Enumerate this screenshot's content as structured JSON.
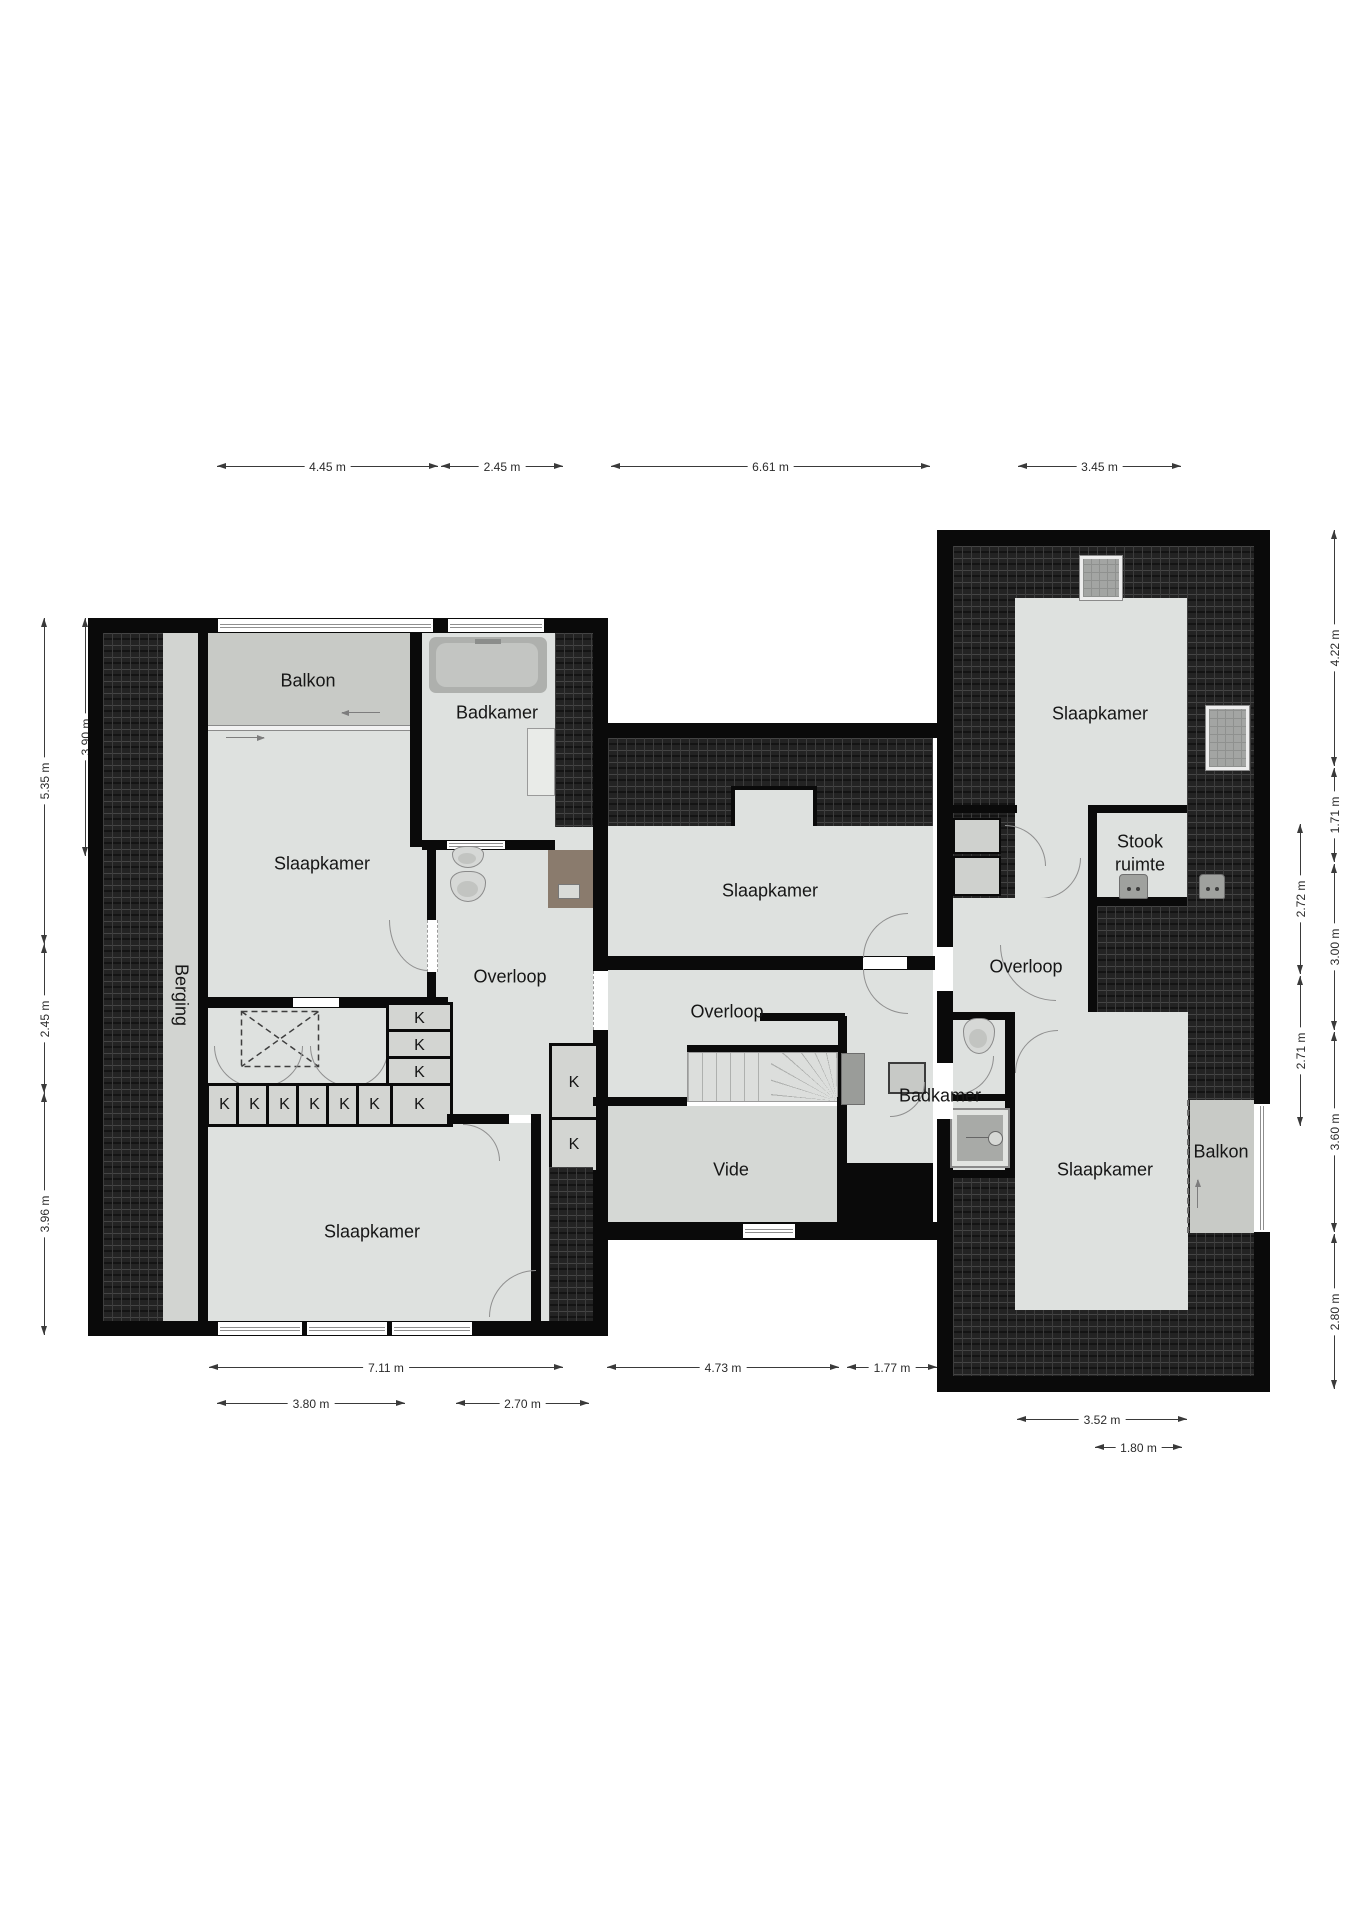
{
  "labels": {
    "closet": "K",
    "rooms": {
      "balkon_left": "Balkon",
      "badkamer_left": "Badkamer",
      "slaapkamer_upper_left": "Slaapkamer",
      "berging": "Berging",
      "overloop_left": "Overloop",
      "slaapkamer_lower_left": "Slaapkamer",
      "slaapkamer_middle": "Slaapkamer",
      "overloop_middle": "Overloop",
      "vide": "Vide",
      "badkamer_middle": "Badkamer",
      "slaapkamer_right_top": "Slaapkamer",
      "stookruimte": "Stook ruimte",
      "overloop_right": "Overloop",
      "slaapkamer_right_bottom": "Slaapkamer",
      "balkon_right": "Balkon"
    }
  },
  "dims": {
    "top": [
      "4.45 m",
      "2.45 m",
      "6.61 m",
      "3.45 m"
    ],
    "left_inner": [
      "3.90 m"
    ],
    "left_outer": [
      "5.35 m",
      "2.45 m",
      "3.96 m"
    ],
    "right_inner": [
      "2.72 m",
      "2.71 m"
    ],
    "right_outer": [
      "4.22 m",
      "1.71 m",
      "3.00 m",
      "3.60 m",
      "2.80 m"
    ],
    "bottom_row1": [
      "7.11 m",
      "4.73 m",
      "1.77 m"
    ],
    "bottom_row2": [
      "3.80 m",
      "2.70 m"
    ],
    "bottom_right": [
      "3.52 m",
      "1.80 m"
    ]
  },
  "colors": {
    "wall": "#0a0a0a",
    "room": "#dee1df",
    "balcony": "#c8cac6",
    "roof": "#232323",
    "shower_brown": "#8a7b6d"
  }
}
